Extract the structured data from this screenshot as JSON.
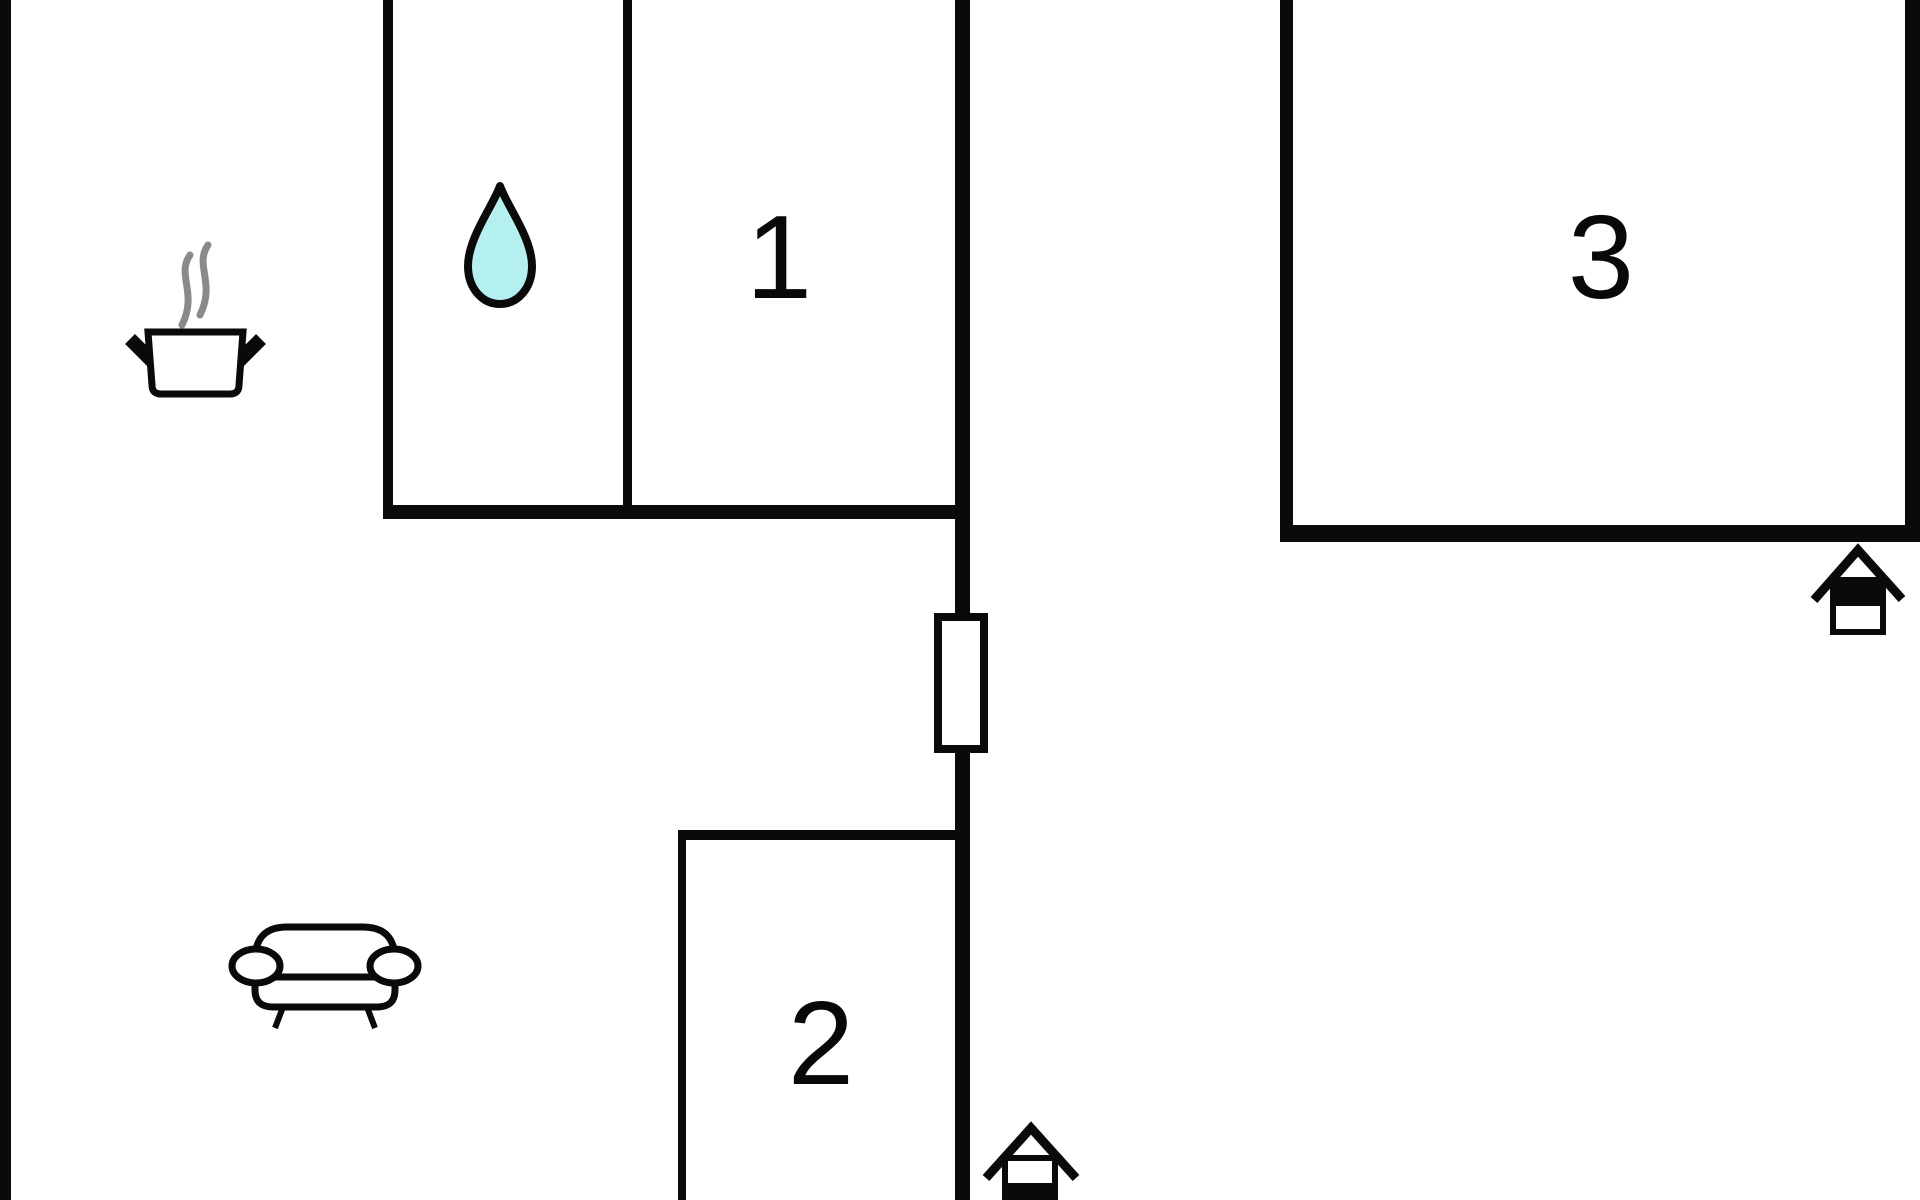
{
  "floorplan": {
    "rooms": [
      {
        "label": "1"
      },
      {
        "label": "2"
      },
      {
        "label": "3"
      }
    ],
    "icons": [
      {
        "name": "water-drop-icon"
      },
      {
        "name": "steaming-pot-icon"
      },
      {
        "name": "sofa-icon"
      },
      {
        "name": "window-symbol"
      },
      {
        "name": "house-entrance-icon-top"
      },
      {
        "name": "house-entrance-icon-bottom"
      }
    ],
    "colors": {
      "wall": "#0a0a0a",
      "background": "#ffffff",
      "drop_fill": "#b4f0f0",
      "steam": "#8a8a8a"
    }
  }
}
